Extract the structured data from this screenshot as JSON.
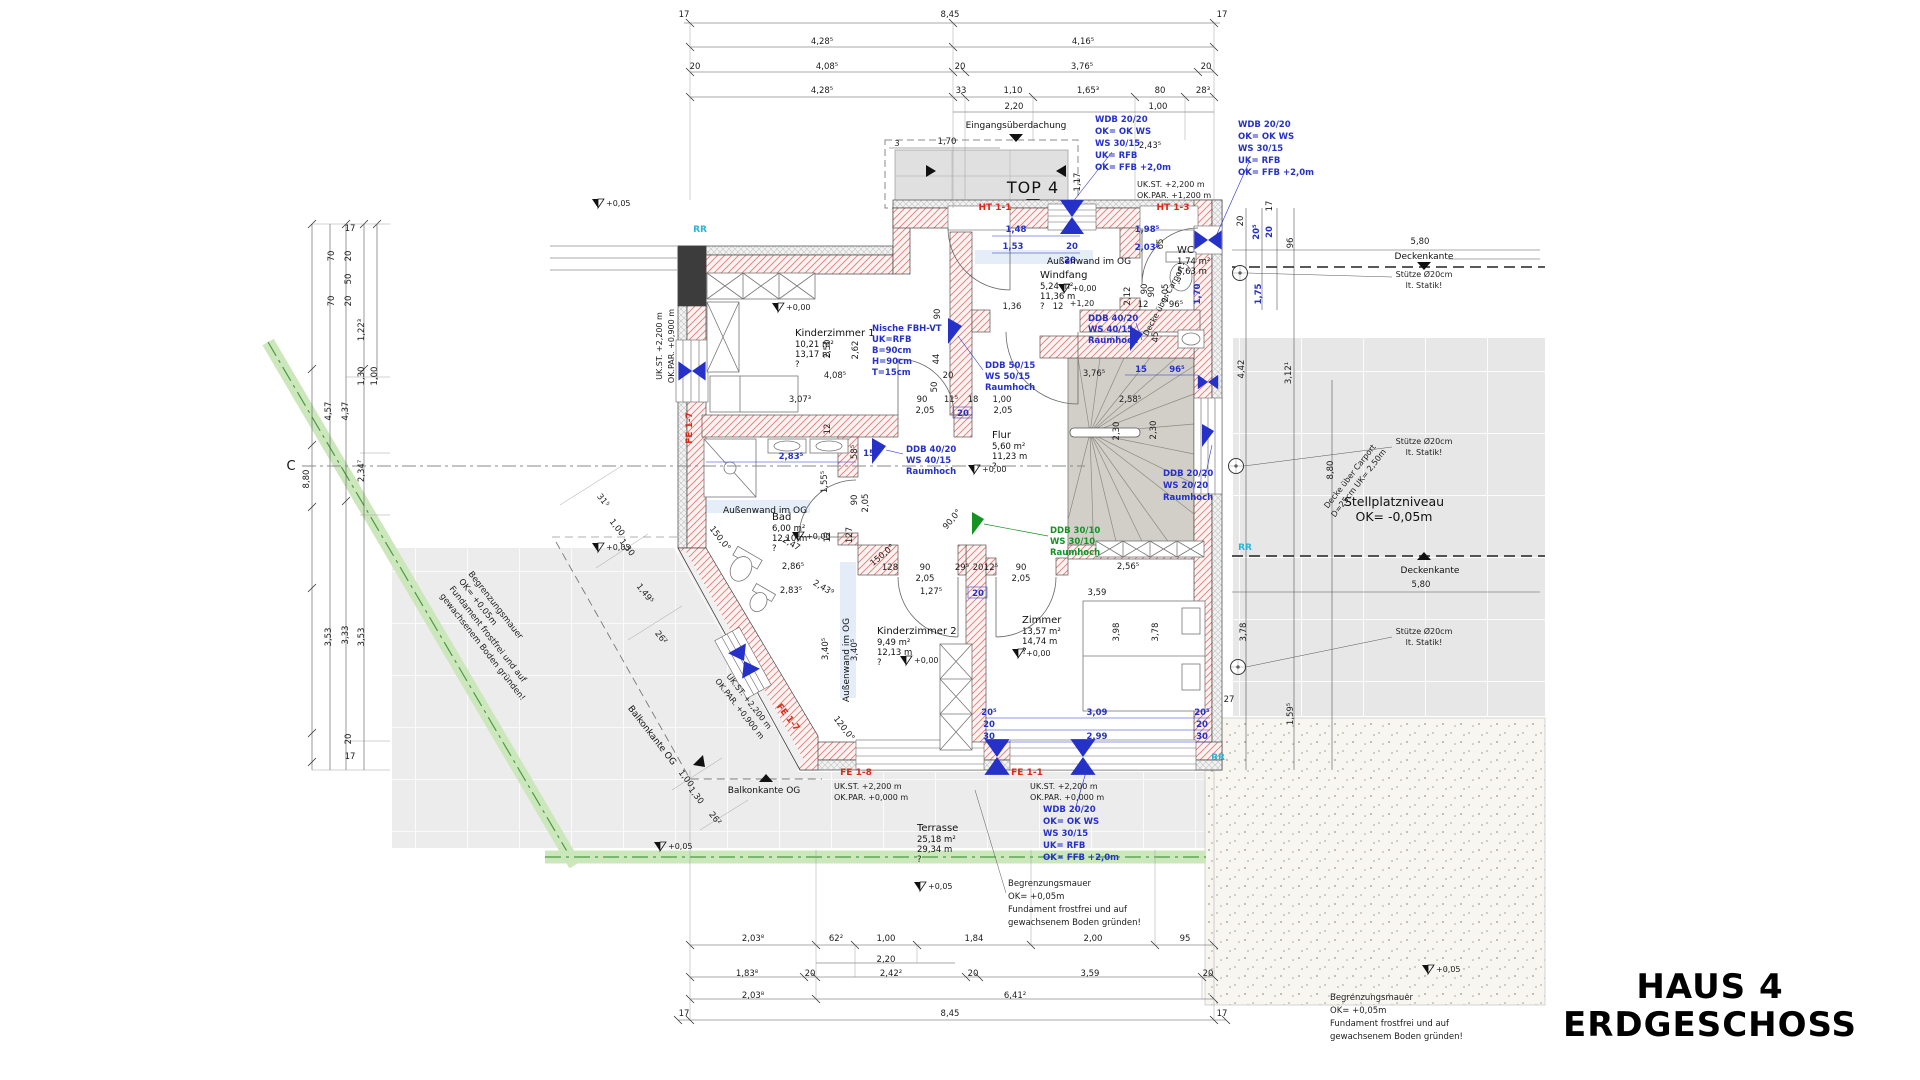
{
  "title": {
    "line1": "HAUS 4",
    "line2": "ERDGESCHOSS"
  },
  "colors": {
    "annotation_blue": "#2531c9",
    "annotation_green": "#149222",
    "label_red": "#e02818",
    "marker_cyan": "#2ab5d8",
    "wall_hatch": "#e27d74",
    "stair_fill": "#d2cfc9",
    "terrace_fill": "#ececec",
    "greenstrip": "#cde7bd"
  },
  "rooms": [
    {
      "name": "Kinderzimmer 1",
      "area": "10,21 m²",
      "perimeter": "13,17 m",
      "q": "?",
      "x": 795,
      "y": 336
    },
    {
      "name": "Windfang",
      "area": "5,24 m²",
      "perimeter": "11,36 m",
      "q": "?",
      "x": 1040,
      "y": 278
    },
    {
      "name": "WC",
      "area": "1,74 m²",
      "perimeter": "5,63 m",
      "q": "?",
      "x": 1177,
      "y": 253
    },
    {
      "name": "Flur",
      "area": "5,60 m²",
      "perimeter": "11,23 m",
      "q": "?",
      "x": 992,
      "y": 438
    },
    {
      "name": "Bad",
      "area": "6,00 m²",
      "perimeter": "12,10 m",
      "q": "?",
      "x": 772,
      "y": 520
    },
    {
      "name": "Kinderzimmer 2",
      "area": "9,49 m²",
      "perimeter": "12,13 m",
      "q": "?",
      "x": 877,
      "y": 634
    },
    {
      "name": "Zimmer",
      "area": "13,57 m²",
      "perimeter": "14,74 m",
      "q": "?",
      "x": 1022,
      "y": 623
    },
    {
      "name": "Terrasse",
      "area": "25,18 m²",
      "perimeter": "29,34 m",
      "q": "?",
      "x": 917,
      "y": 831
    }
  ],
  "levels": [
    {
      "label": "+0,00",
      "x": 778,
      "y": 312
    },
    {
      "label": "+0,00",
      "x": 1064,
      "y": 293
    },
    {
      "label": "+0,00",
      "x": 798,
      "y": 541
    },
    {
      "label": "+0,00",
      "x": 906,
      "y": 665
    },
    {
      "label": "+0,00",
      "x": 1018,
      "y": 658
    },
    {
      "label": "+0,00",
      "x": 974,
      "y": 474
    },
    {
      "label": "+0,05",
      "x": 598,
      "y": 552
    },
    {
      "label": "+0,05",
      "x": 660,
      "y": 851
    },
    {
      "label": "+0,05",
      "x": 920,
      "y": 891
    },
    {
      "label": "+0,05",
      "x": 1428,
      "y": 974
    },
    {
      "label": "+0,05",
      "x": 598,
      "y": 208
    }
  ],
  "blocks": [
    {
      "id": "wdb-top-a",
      "x": 1095,
      "y": 122,
      "lh": 12,
      "cls": "b",
      "a": "s",
      "lines": [
        "WDB 20/20",
        "OK= OK WS",
        "WS 30/15",
        "UK= RFB",
        "OK= FFB +2,0m"
      ]
    },
    {
      "id": "wdb-top-b",
      "x": 1238,
      "y": 127,
      "lh": 12,
      "cls": "b",
      "a": "s",
      "lines": [
        "WDB 20/20",
        "OK= OK WS",
        "WS 30/15",
        "UK= RFB",
        "OK= FFB +2,0m"
      ]
    },
    {
      "id": "wdb-bottom",
      "x": 1043,
      "y": 812,
      "lh": 12,
      "cls": "b",
      "a": "s",
      "lines": [
        "WDB 20/20",
        "OK= OK WS",
        "WS 30/15",
        "UK= RFB",
        "OK= FFB +2,0m"
      ]
    },
    {
      "id": "nische",
      "x": 872,
      "y": 331,
      "lh": 11,
      "cls": "b",
      "a": "s",
      "lines": [
        "Nische FBH-VT",
        "UK=RFB",
        "B=90cm",
        "H=90cm",
        "T=15cm"
      ]
    },
    {
      "id": "ddb-50",
      "x": 985,
      "y": 368,
      "lh": 11,
      "cls": "b",
      "a": "s",
      "lines": [
        "DDB 50/15",
        "WS 50/15",
        "Raumhoch"
      ]
    },
    {
      "id": "ddb-40-wc",
      "x": 1088,
      "y": 321,
      "lh": 11,
      "cls": "b",
      "a": "s",
      "lines": [
        "DDB 40/20",
        "WS 40/15",
        "Raumhoch"
      ]
    },
    {
      "id": "ddb-40-bad",
      "x": 906,
      "y": 452,
      "lh": 11,
      "cls": "b",
      "a": "s",
      "lines": [
        "DDB 40/20",
        "WS 40/15",
        "Raumhoch"
      ]
    },
    {
      "id": "ddb-20",
      "x": 1163,
      "y": 476,
      "lh": 12,
      "cls": "b",
      "a": "s",
      "lines": [
        "DDB 20/20",
        "WS 20/20",
        "Raumhoch"
      ]
    },
    {
      "id": "ddb-30-green",
      "x": 1050,
      "y": 533,
      "lh": 11,
      "cls": "g",
      "a": "s",
      "lines": [
        "DDB 30/10",
        "WS 30/10",
        "Raumhoch"
      ]
    },
    {
      "id": "begrenzung-left",
      "x": 468,
      "y": 574,
      "lh": 12,
      "cls": "d",
      "a": "s",
      "rot": 52,
      "lines": [
        "Begrenzungsmauer",
        "OK= +0,05m",
        "Fundament frostfrei und auf",
        "gewachsenem Boden gründen!"
      ]
    },
    {
      "id": "begrenzung-center",
      "x": 1008,
      "y": 886,
      "lh": 13,
      "cls": "d",
      "a": "s",
      "lines": [
        "Begrenzungsmauer",
        "OK= +0,05m",
        "Fundament frostfrei und auf",
        "gewachsenem Boden gründen!"
      ]
    },
    {
      "id": "begrenzung-right",
      "x": 1330,
      "y": 1000,
      "lh": 13,
      "cls": "d",
      "a": "s",
      "lines": [
        "Begrenzungsmauer",
        "OK= +0,05m",
        "Fundament frostfrei und auf",
        "gewachsenem Boden gründen!"
      ]
    },
    {
      "id": "ukst-top-right",
      "x": 1137,
      "y": 187,
      "lh": 11,
      "cls": "s",
      "a": "s",
      "lines": [
        "UK.ST.      +2,200 m",
        "OK.PAR.   +1,200 m"
      ]
    },
    {
      "id": "ukst-fe18",
      "x": 834,
      "y": 789,
      "lh": 11,
      "cls": "s",
      "a": "s",
      "lines": [
        "UK.ST.     +2,200 m",
        "OK.PAR.  +0,000 m"
      ]
    },
    {
      "id": "ukst-fe11",
      "x": 1030,
      "y": 789,
      "lh": 11,
      "cls": "s",
      "a": "s",
      "lines": [
        "UK.ST.     +2,200 m",
        "OK.PAR.  +0,000 m"
      ]
    },
    {
      "id": "ukst-left",
      "x": 662,
      "y": 346,
      "lh": 12,
      "cls": "s",
      "a": "m",
      "rot": -90,
      "lines": [
        "UK.ST. +2,200 m",
        "OK.PAR. +0,900 m"
      ]
    },
    {
      "id": "ukst-diag",
      "x": 747,
      "y": 703,
      "lh": 12,
      "cls": "s",
      "a": "m",
      "rot": 52,
      "lines": [
        "UK.ST. +2,200 m",
        "OK.PAR. +0,900 m"
      ]
    },
    {
      "id": "stuetze-1",
      "x": 1424,
      "y": 277,
      "lh": 11,
      "cls": "s",
      "a": "m",
      "lines": [
        "Stütze Ø20cm",
        "lt. Statik!"
      ]
    },
    {
      "id": "stuetze-2",
      "x": 1424,
      "y": 444,
      "lh": 11,
      "cls": "s",
      "a": "m",
      "lines": [
        "Stütze Ø20cm",
        "lt. Statik!"
      ]
    },
    {
      "id": "stuetze-3",
      "x": 1424,
      "y": 634,
      "lh": 11,
      "cls": "s",
      "a": "m",
      "lines": [
        "Stütze Ø20cm",
        "lt. Statik!"
      ]
    },
    {
      "id": "stellplatz",
      "x": 1394,
      "y": 506,
      "lh": 15,
      "cls": "S",
      "a": "m",
      "lines": [
        "Stellplatzniveau",
        "OK= -0,05m"
      ]
    },
    {
      "id": "decke-carport",
      "x": 1352,
      "y": 478,
      "lh": 11,
      "cls": "s",
      "a": "m",
      "rot": -52,
      "lines": [
        "Decke über Carport",
        "D=25cm  UK= 2,50m"
      ]
    },
    {
      "id": "decke-carport-2",
      "x": 1166,
      "y": 302,
      "lh": 10,
      "cls": "s",
      "a": "m",
      "rot": -62,
      "lines": [
        "Decke über Carport"
      ]
    }
  ],
  "dims": [
    [
      "17",
      684,
      17,
      "d"
    ],
    [
      "8,45",
      950,
      17,
      "d"
    ],
    [
      "17",
      1222,
      17,
      "d"
    ],
    [
      "4,28⁵",
      822,
      44,
      "d"
    ],
    [
      "4,16⁵",
      1083,
      44,
      "d"
    ],
    [
      "20",
      695,
      69,
      "d"
    ],
    [
      "4,08⁵",
      827,
      69,
      "d"
    ],
    [
      "20",
      960,
      69,
      "d"
    ],
    [
      "3,76⁵",
      1082,
      69,
      "d"
    ],
    [
      "20",
      1206,
      69,
      "d"
    ],
    [
      "4,28⁵",
      822,
      93,
      "d"
    ],
    [
      "33",
      961,
      93,
      "d"
    ],
    [
      "1,10",
      1013,
      93,
      "d"
    ],
    [
      "1,65³",
      1088,
      93,
      "d"
    ],
    [
      "80",
      1160,
      93,
      "d"
    ],
    [
      "28³",
      1203,
      93,
      "d"
    ],
    [
      "2,20",
      1014,
      109,
      "d"
    ],
    [
      "1,00",
      1158,
      109,
      "d"
    ],
    [
      "Eingangsüberdachung",
      1016,
      128,
      "l"
    ],
    [
      "3",
      897,
      146,
      "s"
    ],
    [
      "1,70",
      947,
      144,
      "d"
    ],
    [
      "TOP 4",
      1033,
      193,
      "T"
    ],
    [
      "1,17",
      1080,
      182,
      "d",
      -90
    ],
    [
      "HT 1-1",
      995,
      210,
      "r"
    ],
    [
      "HT 1-3",
      1173,
      210,
      "r"
    ],
    [
      "FE 1-7",
      692,
      428,
      "r",
      -90
    ],
    [
      "FE 1-7",
      786,
      719,
      "r",
      52
    ],
    [
      "FE 1-8",
      856,
      775,
      "r"
    ],
    [
      "FE 1-1",
      1027,
      775,
      "r"
    ],
    [
      "RR",
      700,
      232,
      "c"
    ],
    [
      "RR",
      1245,
      550,
      "c"
    ],
    [
      "RR",
      1218,
      760,
      "c"
    ],
    [
      "2,43⁵",
      1150,
      148,
      "d"
    ],
    [
      "20",
      1243,
      221,
      "d",
      -90
    ],
    [
      "17",
      1272,
      206,
      "d",
      -90
    ],
    [
      "20⁵",
      1259,
      232,
      "b",
      -90
    ],
    [
      "20",
      1272,
      232,
      "b",
      -90
    ],
    [
      "96",
      1293,
      243,
      "d",
      -90
    ],
    [
      "5,80",
      1420,
      244,
      "d"
    ],
    [
      "Deckenkante",
      1424,
      259,
      "l"
    ],
    [
      "1,75",
      1261,
      294,
      "b",
      -90
    ],
    [
      "4,42",
      1244,
      369,
      "d",
      -90
    ],
    [
      "3,12¹",
      1291,
      373,
      "d",
      -90
    ],
    [
      "8,80",
      1333,
      470,
      "d",
      -90
    ],
    [
      "3,78",
      1246,
      632,
      "d",
      -90
    ],
    [
      "27",
      1229,
      702,
      "d"
    ],
    [
      "1,59⁵",
      1293,
      714,
      "d",
      -90
    ],
    [
      "Deckenkante",
      1430,
      573,
      "l"
    ],
    [
      "5,80",
      1421,
      587,
      "d"
    ],
    [
      "17",
      350,
      231,
      "d"
    ],
    [
      "70",
      334,
      256,
      "d",
      -90
    ],
    [
      "20",
      351,
      256,
      "d",
      -90
    ],
    [
      "50",
      351,
      279,
      "d",
      -90
    ],
    [
      "20",
      351,
      301,
      "d",
      -90
    ],
    [
      "70",
      334,
      301,
      "d",
      -90
    ],
    [
      "1,22³",
      364,
      330,
      "d",
      -90
    ],
    [
      "1,00",
      377,
      376,
      "d",
      -90
    ],
    [
      "1,30",
      364,
      376,
      "d",
      -90
    ],
    [
      "4,57",
      331,
      411,
      "d",
      -90
    ],
    [
      "4,37",
      348,
      411,
      "d",
      -90
    ],
    [
      "2,34⁷",
      364,
      471,
      "d",
      -90
    ],
    [
      "8,80",
      309,
      479,
      "d",
      -90
    ],
    [
      "3,53",
      331,
      637,
      "d",
      -90
    ],
    [
      "3,33",
      348,
      635,
      "d",
      -90
    ],
    [
      "3,53",
      364,
      637,
      "d",
      -90
    ],
    [
      "20",
      351,
      739,
      "d",
      -90
    ],
    [
      "17",
      350,
      759,
      "d"
    ],
    [
      "C",
      291,
      470,
      "B"
    ],
    [
      "31⁵",
      601,
      502,
      "d",
      52
    ],
    [
      "1,00",
      615,
      529,
      "d",
      52
    ],
    [
      "1,30",
      625,
      549,
      "d",
      52
    ],
    [
      "1,49⁵",
      643,
      595,
      "d",
      52
    ],
    [
      "26²",
      659,
      639,
      "d",
      52
    ],
    [
      "Balkonkante OG",
      650,
      737,
      "l",
      52
    ],
    [
      "1,00",
      684,
      780,
      "d",
      52
    ],
    [
      "1,30",
      694,
      797,
      "d",
      52
    ],
    [
      "26²",
      713,
      820,
      "d",
      52
    ],
    [
      "120,0°",
      842,
      730,
      "d",
      52
    ],
    [
      "Balkonkante OG",
      764,
      793,
      "l"
    ],
    [
      "2,03⁸",
      753,
      941,
      "d"
    ],
    [
      "62²",
      836,
      941,
      "d"
    ],
    [
      "1,00",
      886,
      941,
      "d"
    ],
    [
      "1,84",
      974,
      941,
      "d"
    ],
    [
      "2,00",
      1093,
      941,
      "d"
    ],
    [
      "95",
      1185,
      941,
      "d"
    ],
    [
      "2,20",
      886,
      962,
      "d"
    ],
    [
      "1,83⁸",
      747,
      976,
      "d"
    ],
    [
      "20",
      810,
      976,
      "d"
    ],
    [
      "2,42²",
      891,
      976,
      "d"
    ],
    [
      "20",
      973,
      976,
      "d"
    ],
    [
      "3,59",
      1090,
      976,
      "d"
    ],
    [
      "20",
      1208,
      976,
      "d"
    ],
    [
      "2,03⁸",
      753,
      998,
      "d"
    ],
    [
      "6,41²",
      1015,
      998,
      "d"
    ],
    [
      "17",
      684,
      1016,
      "d"
    ],
    [
      "8,45",
      950,
      1016,
      "d"
    ],
    [
      "17",
      1222,
      1016,
      "d"
    ],
    [
      "2,50",
      830,
      349,
      "d",
      -90
    ],
    [
      "2,62",
      858,
      350,
      "d",
      -90
    ],
    [
      "4,08⁵",
      835,
      378,
      "d"
    ],
    [
      "3,07³",
      800,
      402,
      "d"
    ],
    [
      "90",
      922,
      402,
      "d"
    ],
    [
      "2,05",
      925,
      413,
      "d"
    ],
    [
      "20",
      948,
      378,
      "d"
    ],
    [
      "11⁵",
      951,
      402,
      "d"
    ],
    [
      "18",
      973,
      402,
      "d"
    ],
    [
      "1,00",
      1002,
      402,
      "d"
    ],
    [
      "2,05",
      1003,
      413,
      "d"
    ],
    [
      "20",
      963,
      416,
      "b"
    ],
    [
      "50",
      937,
      387,
      "d",
      -90
    ],
    [
      "44",
      939,
      359,
      "d",
      -90
    ],
    [
      "90",
      940,
      314,
      "d",
      -90
    ],
    [
      "1,48",
      1016,
      232,
      "b"
    ],
    [
      "1,53",
      1013,
      249,
      "b"
    ],
    [
      "30",
      1074,
      232,
      "b"
    ],
    [
      "20",
      1072,
      249,
      "b"
    ],
    [
      "20",
      1070,
      263,
      "b"
    ],
    [
      "1,36",
      1012,
      309,
      "d"
    ],
    [
      "12",
      1058,
      309,
      "d"
    ],
    [
      "90",
      1147,
      289,
      "d",
      -90
    ],
    [
      "96⁵",
      1176,
      307,
      "d"
    ],
    [
      "12",
      1143,
      307,
      "d"
    ],
    [
      "45",
      1158,
      337,
      "d",
      -90
    ],
    [
      "65",
      1163,
      244,
      "d",
      -90
    ],
    [
      "2,12",
      1130,
      296,
      "d",
      -90
    ],
    [
      "90",
      1154,
      292,
      "d",
      -90
    ],
    [
      "2,05",
      1168,
      293,
      "d",
      -90
    ],
    [
      "1,70",
      1200,
      294,
      "b",
      -90
    ],
    [
      "1,98⁵",
      1147,
      232,
      "b"
    ],
    [
      "2,03⁵",
      1147,
      250,
      "b"
    ],
    [
      "+1,20",
      1082,
      306,
      "s"
    ],
    [
      "3,76⁵",
      1094,
      376,
      "d"
    ],
    [
      "15",
      1141,
      372,
      "b"
    ],
    [
      "96⁵",
      1177,
      372,
      "b"
    ],
    [
      "2,58⁵",
      1130,
      402,
      "d"
    ],
    [
      "2,30",
      1119,
      431,
      "d",
      -90
    ],
    [
      "2,30",
      1156,
      430,
      "d",
      -90
    ],
    [
      "2,83⁵",
      791,
      459,
      "b"
    ],
    [
      "1,55⁵",
      827,
      482,
      "d",
      -90
    ],
    [
      "12",
      830,
      429,
      "d",
      -90
    ],
    [
      "58⁵",
      857,
      452,
      "d",
      -90
    ],
    [
      "15",
      869,
      456,
      "b"
    ],
    [
      "150,0°",
      718,
      540,
      "d",
      52
    ],
    [
      "2,47",
      790,
      546,
      "d",
      30
    ],
    [
      "2,86⁵",
      793,
      569,
      "d"
    ],
    [
      "2,83⁵",
      791,
      593,
      "d"
    ],
    [
      "2,43⁹",
      822,
      590,
      "d",
      30
    ],
    [
      "3,40⁵",
      828,
      649,
      "d",
      -90
    ],
    [
      "3,40⁵",
      857,
      650,
      "d",
      -90
    ],
    [
      "12",
      830,
      537,
      "d",
      -90
    ],
    [
      "127",
      852,
      535,
      "d",
      -90
    ],
    [
      "90",
      857,
      500,
      "d",
      -90
    ],
    [
      "2,05",
      868,
      503,
      "d",
      -90
    ],
    [
      "150,0°",
      884,
      557,
      "d",
      -40
    ],
    [
      "128",
      890,
      570,
      "d"
    ],
    [
      "90",
      925,
      570,
      "d"
    ],
    [
      "2,05",
      925,
      581,
      "d"
    ],
    [
      "29⁵",
      962,
      570,
      "d"
    ],
    [
      "20",
      978,
      570,
      "d"
    ],
    [
      "12⁵",
      991,
      570,
      "d"
    ],
    [
      "90",
      1021,
      570,
      "d"
    ],
    [
      "2,05",
      1021,
      581,
      "d"
    ],
    [
      "1,27⁵",
      931,
      594,
      "d"
    ],
    [
      "20",
      978,
      596,
      "b"
    ],
    [
      "90,0°",
      954,
      521,
      "d",
      -50
    ],
    [
      "2,56⁵",
      1128,
      569,
      "d"
    ],
    [
      "3,59",
      1097,
      595,
      "d"
    ],
    [
      "3,98",
      1119,
      632,
      "d",
      -90
    ],
    [
      "3,78",
      1158,
      632,
      "d",
      -90
    ],
    [
      "3,09",
      1097,
      715,
      "b"
    ],
    [
      "2,99",
      1097,
      739,
      "b"
    ],
    [
      "20⁵",
      989,
      715,
      "b"
    ],
    [
      "20",
      989,
      727,
      "b"
    ],
    [
      "30",
      989,
      739,
      "b"
    ],
    [
      "20⁵",
      1202,
      715,
      "b"
    ],
    [
      "20",
      1202,
      727,
      "b"
    ],
    [
      "30",
      1202,
      739,
      "b"
    ],
    [
      "Außenwand im OG",
      1089,
      264,
      "l"
    ],
    [
      "Außenwand im OG",
      765,
      513,
      "l"
    ],
    [
      "Außenwand im OG",
      849,
      660,
      "l",
      -90
    ]
  ]
}
